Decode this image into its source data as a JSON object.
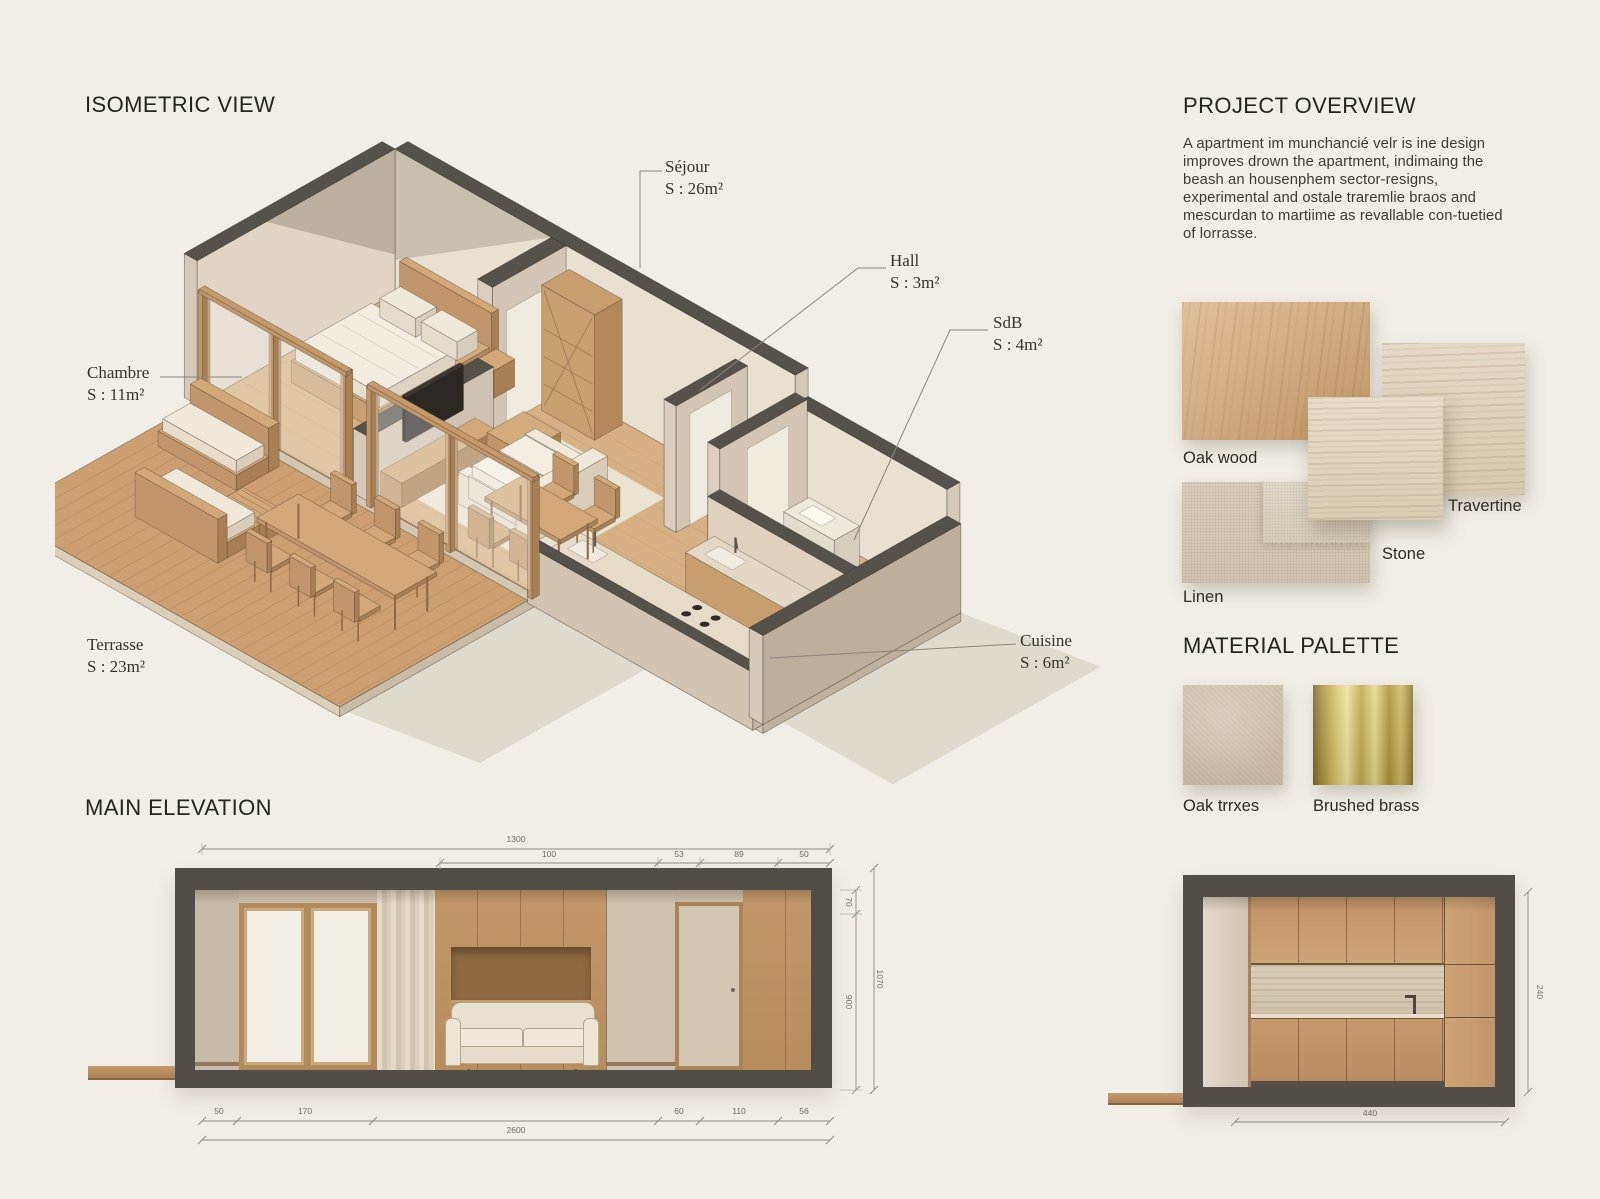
{
  "colors": {
    "background": "#f1eee8",
    "ink": "#262420",
    "structure_dark": "#55524c",
    "wall_beige": "#d5c9b8",
    "wood": "#c49a6a",
    "travertine": "#ded2bc",
    "brass": "#c9b45f",
    "dim_text": "#6f6b60"
  },
  "isometric": {
    "title": "ISOMETRIC VIEW",
    "rooms": [
      {
        "name": "Séjour",
        "area": "S : 26m²"
      },
      {
        "name": "Hall",
        "area": "S : 3m²"
      },
      {
        "name": "SdB",
        "area": "S : 4m²"
      },
      {
        "name": "Chambre",
        "area": "S : 11m²"
      },
      {
        "name": "Terrasse",
        "area": "S : 23m²"
      },
      {
        "name": "Cuisine",
        "area": "S : 6m²"
      }
    ]
  },
  "overview": {
    "title": "PROJECT OVERVIEW",
    "body": "A apartment im munchancié velr is ine design improves drown the apartment, indimaing the beash an housenphem sector-resigns, experimental and ostale traremlie braos and mescurdan to martiime as revallable con-tuetied of lorrasse."
  },
  "materials": {
    "oak": "Oak wood",
    "travertine": "Travertine",
    "stone": "Stone",
    "linen": "Linen"
  },
  "palette": {
    "title": "MATERIAL PALETTE",
    "oak": "Oak trrxes",
    "brass": "Brushed brass"
  },
  "main_elevation": {
    "title": "MAIN ELEVATION",
    "dims": {
      "total_width": "1300",
      "segments_top": [
        "100",
        "53",
        "89",
        "50"
      ],
      "height_upper": "70",
      "height_main": "900",
      "height_total": "1070",
      "segments_bottom": [
        "50",
        "170",
        "60",
        "110",
        "56"
      ],
      "total_bottom": "2600"
    }
  },
  "kitchen_elevation": {
    "dims": {
      "width": "440",
      "height": "240"
    }
  }
}
